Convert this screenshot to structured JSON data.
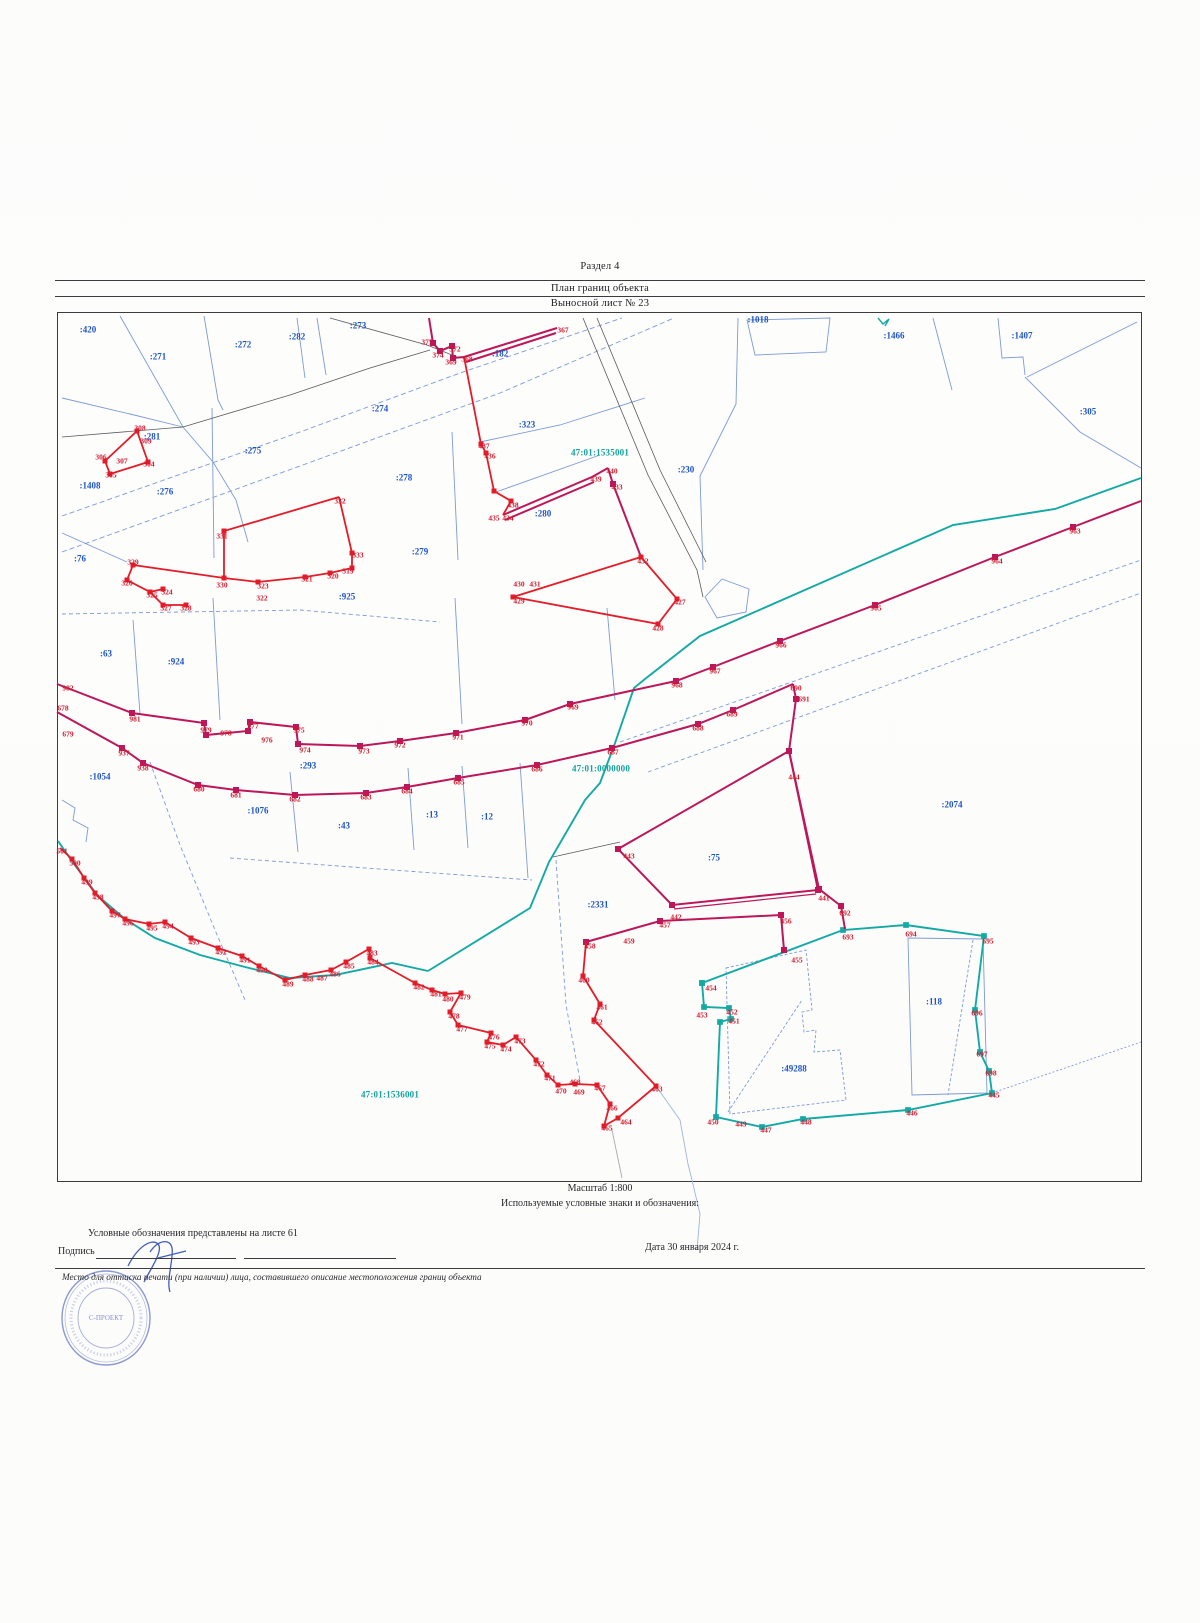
{
  "header": {
    "section_title": "Раздел 4",
    "plan_title": "План границ объекта",
    "sheet_label": "Выносной лист № 23"
  },
  "footer": {
    "scale": "Масштаб 1:800",
    "symbols_note": "Используемые условные знаки и обозначения:",
    "legend_note": "Условные обозначения представлены на листе 61",
    "signature_label": "Подпись",
    "date_label": "Дата 30 января 2024 г.",
    "seal_note": "Место для оттиска печати (при наличии) лица, составившего описание местоположения границ объекта",
    "stamp_center_text": "С-ПРОЕКТ"
  },
  "colors": {
    "boundary_red": "#e41b28",
    "boundary_crimson": "#bd1659",
    "boundary_teal": "#13a9a4",
    "parcel_blue": "#7d9ad6",
    "label_red": "#d21a2e",
    "label_blue": "#1d53cb",
    "label_teal": "#11a39e",
    "stamp_blue": "#7280cc"
  },
  "map": {
    "quarter_labels": [
      {
        "t": "47:01:1535001",
        "x": 600,
        "y": 453
      },
      {
        "t": "47:01:0000000",
        "x": 601,
        "y": 769
      },
      {
        "t": "47:01:1536001",
        "x": 390,
        "y": 1095
      }
    ],
    "parcel_labels": [
      {
        "t": ":420",
        "x": 88,
        "y": 330
      },
      {
        "t": ":271",
        "x": 158,
        "y": 357
      },
      {
        "t": ":272",
        "x": 243,
        "y": 345
      },
      {
        "t": ":282",
        "x": 297,
        "y": 337
      },
      {
        "t": ":273",
        "x": 358,
        "y": 326
      },
      {
        "t": ":1018",
        "x": 758,
        "y": 320
      },
      {
        "t": ":1466",
        "x": 894,
        "y": 336
      },
      {
        "t": ":1407",
        "x": 1022,
        "y": 336
      },
      {
        "t": ":305",
        "x": 1088,
        "y": 412
      },
      {
        "t": ":274",
        "x": 380,
        "y": 409
      },
      {
        "t": ":182",
        "x": 500,
        "y": 354
      },
      {
        "t": ":281",
        "x": 152,
        "y": 437
      },
      {
        "t": ":275",
        "x": 253,
        "y": 451
      },
      {
        "t": ":276",
        "x": 165,
        "y": 492
      },
      {
        "t": ":278",
        "x": 404,
        "y": 478
      },
      {
        "t": ":323",
        "x": 527,
        "y": 425
      },
      {
        "t": ":280",
        "x": 543,
        "y": 514
      },
      {
        "t": ":230",
        "x": 686,
        "y": 470
      },
      {
        "t": ":279",
        "x": 420,
        "y": 552
      },
      {
        "t": ":76",
        "x": 80,
        "y": 559
      },
      {
        "t": ":1408",
        "x": 90,
        "y": 486
      },
      {
        "t": ":925",
        "x": 347,
        "y": 597
      },
      {
        "t": ":63",
        "x": 106,
        "y": 654
      },
      {
        "t": ":924",
        "x": 176,
        "y": 662
      },
      {
        "t": ":293",
        "x": 308,
        "y": 766
      },
      {
        "t": ":1054",
        "x": 100,
        "y": 777
      },
      {
        "t": ":1076",
        "x": 258,
        "y": 811
      },
      {
        "t": ":43",
        "x": 344,
        "y": 826
      },
      {
        "t": ":13",
        "x": 432,
        "y": 815
      },
      {
        "t": ":12",
        "x": 487,
        "y": 817
      },
      {
        "t": ":2074",
        "x": 952,
        "y": 805
      },
      {
        "t": ":75",
        "x": 714,
        "y": 858
      },
      {
        "t": ":2331",
        "x": 598,
        "y": 905
      },
      {
        "t": ":118",
        "x": 934,
        "y": 1002
      },
      {
        "t": ":49288",
        "x": 794,
        "y": 1069
      }
    ],
    "point_labels": [
      {
        "t": "304",
        "x": 149,
        "y": 464
      },
      {
        "t": "305",
        "x": 111,
        "y": 475
      },
      {
        "t": "306",
        "x": 101,
        "y": 457
      },
      {
        "t": "307",
        "x": 122,
        "y": 461
      },
      {
        "t": "308",
        "x": 140,
        "y": 428
      },
      {
        "t": "309",
        "x": 146,
        "y": 441
      },
      {
        "t": "319",
        "x": 348,
        "y": 571
      },
      {
        "t": "320",
        "x": 333,
        "y": 576
      },
      {
        "t": "321",
        "x": 307,
        "y": 579
      },
      {
        "t": "322",
        "x": 262,
        "y": 598
      },
      {
        "t": "323",
        "x": 263,
        "y": 586
      },
      {
        "t": "324",
        "x": 167,
        "y": 592
      },
      {
        "t": "325",
        "x": 152,
        "y": 595
      },
      {
        "t": "326",
        "x": 127,
        "y": 583
      },
      {
        "t": "327",
        "x": 166,
        "y": 608
      },
      {
        "t": "328",
        "x": 186,
        "y": 608
      },
      {
        "t": "329",
        "x": 133,
        "y": 562
      },
      {
        "t": "330",
        "x": 222,
        "y": 585
      },
      {
        "t": "331",
        "x": 222,
        "y": 536
      },
      {
        "t": "332",
        "x": 340,
        "y": 501
      },
      {
        "t": "333",
        "x": 358,
        "y": 555
      },
      {
        "t": "367",
        "x": 563,
        "y": 330
      },
      {
        "t": "368",
        "x": 467,
        "y": 359
      },
      {
        "t": "369",
        "x": 451,
        "y": 362
      },
      {
        "t": "372",
        "x": 455,
        "y": 349
      },
      {
        "t": "374",
        "x": 438,
        "y": 355
      },
      {
        "t": "375",
        "x": 427,
        "y": 342
      },
      {
        "t": "427",
        "x": 680,
        "y": 602
      },
      {
        "t": "428",
        "x": 658,
        "y": 628
      },
      {
        "t": "429",
        "x": 519,
        "y": 601
      },
      {
        "t": "430",
        "x": 519,
        "y": 584
      },
      {
        "t": "431",
        "x": 535,
        "y": 584
      },
      {
        "t": "432",
        "x": 643,
        "y": 561
      },
      {
        "t": "433",
        "x": 617,
        "y": 487
      },
      {
        "t": "434",
        "x": 508,
        "y": 518
      },
      {
        "t": "435",
        "x": 494,
        "y": 518
      },
      {
        "t": "436",
        "x": 490,
        "y": 456
      },
      {
        "t": "437",
        "x": 484,
        "y": 446
      },
      {
        "t": "438",
        "x": 513,
        "y": 505
      },
      {
        "t": "439",
        "x": 596,
        "y": 479
      },
      {
        "t": "440",
        "x": 612,
        "y": 471
      },
      {
        "t": "441",
        "x": 824,
        "y": 898
      },
      {
        "t": "442",
        "x": 676,
        "y": 917
      },
      {
        "t": "443",
        "x": 629,
        "y": 856
      },
      {
        "t": "444",
        "x": 794,
        "y": 777
      },
      {
        "t": "445",
        "x": 994,
        "y": 1095
      },
      {
        "t": "446",
        "x": 912,
        "y": 1113
      },
      {
        "t": "447",
        "x": 766,
        "y": 1130
      },
      {
        "t": "448",
        "x": 806,
        "y": 1122
      },
      {
        "t": "449",
        "x": 741,
        "y": 1124
      },
      {
        "t": "450",
        "x": 713,
        "y": 1122
      },
      {
        "t": "451",
        "x": 734,
        "y": 1021
      },
      {
        "t": "452",
        "x": 732,
        "y": 1012
      },
      {
        "t": "453",
        "x": 702,
        "y": 1015
      },
      {
        "t": "454",
        "x": 711,
        "y": 988
      },
      {
        "t": "455",
        "x": 797,
        "y": 960
      },
      {
        "t": "456",
        "x": 786,
        "y": 921
      },
      {
        "t": "457",
        "x": 665,
        "y": 925
      },
      {
        "t": "458",
        "x": 590,
        "y": 946
      },
      {
        "t": "459",
        "x": 629,
        "y": 941
      },
      {
        "t": "460",
        "x": 584,
        "y": 980
      },
      {
        "t": "461",
        "x": 602,
        "y": 1007
      },
      {
        "t": "462",
        "x": 597,
        "y": 1022
      },
      {
        "t": "463",
        "x": 657,
        "y": 1089
      },
      {
        "t": "464",
        "x": 626,
        "y": 1122
      },
      {
        "t": "465",
        "x": 607,
        "y": 1128
      },
      {
        "t": "466",
        "x": 612,
        "y": 1108
      },
      {
        "t": "467",
        "x": 600,
        "y": 1088
      },
      {
        "t": "468",
        "x": 575,
        "y": 1082
      },
      {
        "t": "469",
        "x": 579,
        "y": 1092
      },
      {
        "t": "470",
        "x": 561,
        "y": 1091
      },
      {
        "t": "471",
        "x": 550,
        "y": 1078
      },
      {
        "t": "472",
        "x": 539,
        "y": 1064
      },
      {
        "t": "473",
        "x": 520,
        "y": 1041
      },
      {
        "t": "474",
        "x": 506,
        "y": 1049
      },
      {
        "t": "475",
        "x": 490,
        "y": 1046
      },
      {
        "t": "476",
        "x": 494,
        "y": 1037
      },
      {
        "t": "477",
        "x": 462,
        "y": 1029
      },
      {
        "t": "478",
        "x": 454,
        "y": 1016
      },
      {
        "t": "479",
        "x": 465,
        "y": 997
      },
      {
        "t": "480",
        "x": 448,
        "y": 999
      },
      {
        "t": "481",
        "x": 436,
        "y": 994
      },
      {
        "t": "482",
        "x": 419,
        "y": 987
      },
      {
        "t": "483",
        "x": 372,
        "y": 953
      },
      {
        "t": "484",
        "x": 373,
        "y": 962
      },
      {
        "t": "485",
        "x": 349,
        "y": 966
      },
      {
        "t": "486",
        "x": 335,
        "y": 974
      },
      {
        "t": "487",
        "x": 322,
        "y": 978
      },
      {
        "t": "488",
        "x": 308,
        "y": 979
      },
      {
        "t": "489",
        "x": 288,
        "y": 984
      },
      {
        "t": "490",
        "x": 262,
        "y": 970
      },
      {
        "t": "491",
        "x": 245,
        "y": 960
      },
      {
        "t": "492",
        "x": 221,
        "y": 952
      },
      {
        "t": "493",
        "x": 194,
        "y": 942
      },
      {
        "t": "494",
        "x": 168,
        "y": 926
      },
      {
        "t": "495",
        "x": 152,
        "y": 928
      },
      {
        "t": "496",
        "x": 128,
        "y": 923
      },
      {
        "t": "497",
        "x": 115,
        "y": 915
      },
      {
        "t": "498",
        "x": 98,
        "y": 897
      },
      {
        "t": "499",
        "x": 87,
        "y": 882
      },
      {
        "t": "500",
        "x": 75,
        "y": 863
      },
      {
        "t": "501",
        "x": 62,
        "y": 851
      },
      {
        "t": "678",
        "x": 63,
        "y": 708
      },
      {
        "t": "679",
        "x": 68,
        "y": 734
      },
      {
        "t": "680",
        "x": 199,
        "y": 789
      },
      {
        "t": "681",
        "x": 236,
        "y": 795
      },
      {
        "t": "682",
        "x": 295,
        "y": 799
      },
      {
        "t": "683",
        "x": 366,
        "y": 797
      },
      {
        "t": "684",
        "x": 407,
        "y": 791
      },
      {
        "t": "685",
        "x": 459,
        "y": 782
      },
      {
        "t": "686",
        "x": 537,
        "y": 769
      },
      {
        "t": "687",
        "x": 613,
        "y": 752
      },
      {
        "t": "688",
        "x": 698,
        "y": 728
      },
      {
        "t": "689",
        "x": 732,
        "y": 714
      },
      {
        "t": "690",
        "x": 796,
        "y": 688
      },
      {
        "t": "691",
        "x": 804,
        "y": 699
      },
      {
        "t": "692",
        "x": 845,
        "y": 913
      },
      {
        "t": "693",
        "x": 848,
        "y": 937
      },
      {
        "t": "694",
        "x": 911,
        "y": 934
      },
      {
        "t": "695",
        "x": 988,
        "y": 941
      },
      {
        "t": "696",
        "x": 977,
        "y": 1013
      },
      {
        "t": "697",
        "x": 982,
        "y": 1054
      },
      {
        "t": "698",
        "x": 991,
        "y": 1073
      },
      {
        "t": "937",
        "x": 124,
        "y": 753
      },
      {
        "t": "938",
        "x": 143,
        "y": 768
      },
      {
        "t": "963",
        "x": 1075,
        "y": 531
      },
      {
        "t": "964",
        "x": 997,
        "y": 561
      },
      {
        "t": "965",
        "x": 876,
        "y": 608
      },
      {
        "t": "966",
        "x": 781,
        "y": 645
      },
      {
        "t": "967",
        "x": 715,
        "y": 671
      },
      {
        "t": "968",
        "x": 677,
        "y": 685
      },
      {
        "t": "969",
        "x": 573,
        "y": 707
      },
      {
        "t": "970",
        "x": 527,
        "y": 723
      },
      {
        "t": "971",
        "x": 458,
        "y": 737
      },
      {
        "t": "972",
        "x": 400,
        "y": 745
      },
      {
        "t": "973",
        "x": 364,
        "y": 751
      },
      {
        "t": "974",
        "x": 305,
        "y": 750
      },
      {
        "t": "975",
        "x": 299,
        "y": 730
      },
      {
        "t": "976",
        "x": 267,
        "y": 740
      },
      {
        "t": "977",
        "x": 253,
        "y": 726
      },
      {
        "t": "978",
        "x": 226,
        "y": 733
      },
      {
        "t": "979",
        "x": 206,
        "y": 730
      },
      {
        "t": "981",
        "x": 135,
        "y": 719
      },
      {
        "t": "982",
        "x": 68,
        "y": 688
      }
    ]
  }
}
